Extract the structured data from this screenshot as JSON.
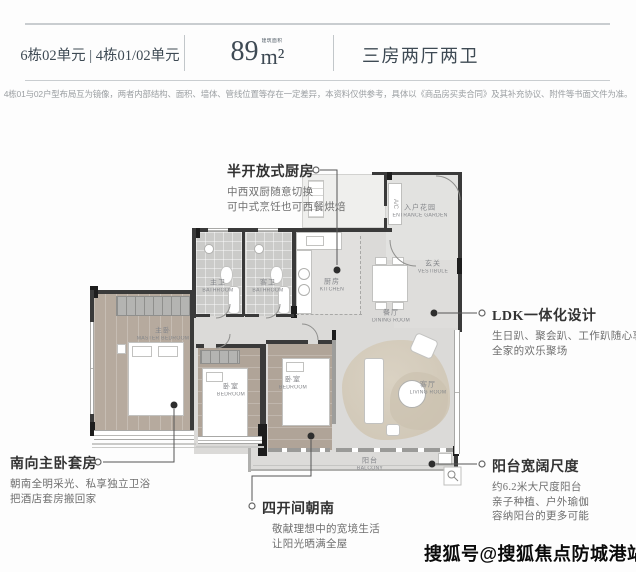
{
  "header": {
    "units": "6栋02单元 | 4栋01/02单元",
    "area_num": "89",
    "area_unit": "m²",
    "area_note": "建筑面积",
    "layout": "三房两厅两卫"
  },
  "disclaimer": "4栋01与02户型布局互为镜像，两者内部结构、面积、墙体、管线位置等存在一定差异，本资料仅供参考，具体以《商品房买卖合同》及其补充协议、附件等书面文件为准。",
  "annotations": {
    "kitchen": {
      "title": "半开放式厨房",
      "lines": [
        "中西双厨随意切换",
        "可中式烹饪也可西餐烘焙"
      ]
    },
    "ldk": {
      "title": "LDK一体化设计",
      "lines": [
        "生日趴、聚会趴、工作趴随心享",
        "全家的欢乐聚场"
      ]
    },
    "master": {
      "title": "南向主卧套房",
      "lines": [
        "朝南全明采光、私享独立卫浴",
        "把酒店套房搬回家"
      ]
    },
    "south": {
      "title": "四开间朝南",
      "lines": [
        "敬献理想中的宽境生活",
        "让阳光晒满全屋"
      ]
    },
    "balcony": {
      "title": "阳台宽阔尺度",
      "lines": [
        "约6.2米大尺度阳台",
        "亲子种植、户外瑜伽",
        "容纳阳台的更多可能"
      ]
    }
  },
  "floorplan": {
    "rooms": {
      "entrance": {
        "zh": "入户花园",
        "en": "ENTRANCE GARDEN"
      },
      "vestibule": {
        "zh": "玄关",
        "en": "VESTIBULE"
      },
      "kitchen": {
        "zh": "厨房",
        "en": "KITCHEN"
      },
      "dining": {
        "zh": "餐厅",
        "en": "DINING ROOM"
      },
      "bath_master": {
        "zh": "主卫",
        "en": "BATHROOM"
      },
      "bath_guest": {
        "zh": "客卫",
        "en": "BATHROOM"
      },
      "master": {
        "zh": "主卧",
        "en": "MASTER BEDROOM"
      },
      "bedroom1": {
        "zh": "卧室",
        "en": "BEDROOM"
      },
      "bedroom2": {
        "zh": "卧室",
        "en": "BEDROOM"
      },
      "living": {
        "zh": "客厅",
        "en": "LIVING ROOM"
      },
      "balcony": {
        "zh": "阳台",
        "en": "BALCONY"
      }
    },
    "ac_label": "A/C"
  },
  "watermark": "搜狐号@搜狐焦点防城港站",
  "colors": {
    "header_text": "#3e4a54",
    "wall": "#3a3a3a",
    "wood_floor": "#b6aa9e",
    "note_title": "#333333",
    "note_body": "#6f6f6f",
    "leader_line": "#555555"
  }
}
